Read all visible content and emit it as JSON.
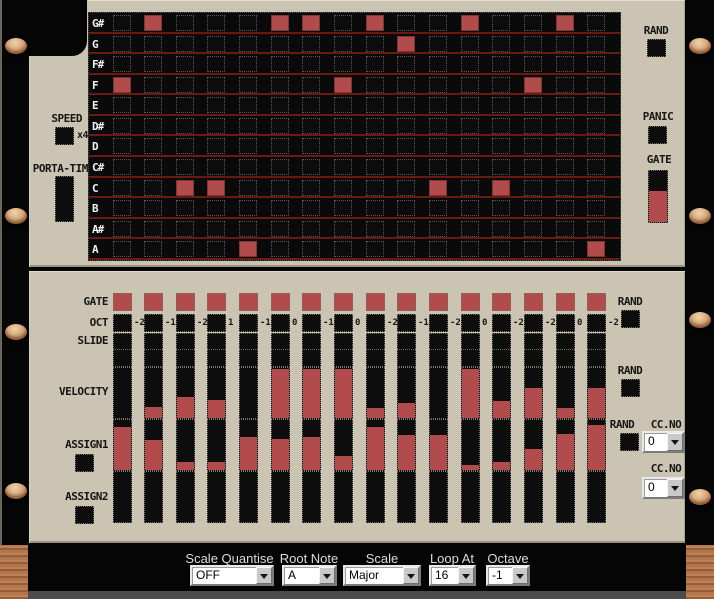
{
  "steps": 16,
  "colors": {
    "panel": "#cbc4b2",
    "active_step": "#b24c4c",
    "grid_line": "#6b1a12",
    "grid_bg": "#0a0a0a",
    "screw": "#d8a97c",
    "wood": "#b3754a"
  },
  "top_panel": {
    "speed": {
      "label": "SPEED",
      "value": "x4"
    },
    "porta": {
      "label": "PORTA-TIME"
    },
    "rand_label": "RAND",
    "panic_label": "PANIC",
    "gate": {
      "label": "GATE",
      "fill": 0.6
    },
    "note_grid": {
      "rows": [
        {
          "label": "G#",
          "steps": [
            2,
            6,
            7,
            9,
            12,
            15
          ]
        },
        {
          "label": "G",
          "steps": [
            10
          ]
        },
        {
          "label": "F#",
          "steps": []
        },
        {
          "label": "F",
          "steps": [
            1,
            8,
            14
          ]
        },
        {
          "label": "E",
          "steps": []
        },
        {
          "label": "D#",
          "steps": []
        },
        {
          "label": "D",
          "steps": []
        },
        {
          "label": "C#",
          "steps": []
        },
        {
          "label": "C",
          "steps": [
            3,
            4,
            11,
            13
          ]
        },
        {
          "label": "B",
          "steps": []
        },
        {
          "label": "A#",
          "steps": []
        },
        {
          "label": "A",
          "steps": [
            5,
            16
          ]
        }
      ]
    }
  },
  "bottom_panel": {
    "gate": {
      "label": "GATE",
      "values": [
        1,
        1,
        1,
        1,
        1,
        1,
        1,
        1,
        1,
        1,
        1,
        1,
        1,
        1,
        1,
        1
      ]
    },
    "oct": {
      "label": "OCT",
      "values": [
        -2,
        -1,
        -2,
        1,
        -1,
        0,
        -1,
        0,
        -2,
        -1,
        -2,
        0,
        -2,
        -2,
        0,
        -2
      ]
    },
    "slide": {
      "label": "SLIDE",
      "values": [
        0,
        0,
        0,
        0,
        0,
        0,
        0,
        0,
        0,
        0,
        0,
        0,
        0,
        0,
        0,
        0
      ]
    },
    "extra_row": {
      "values": [
        0,
        0,
        0,
        0,
        0,
        0,
        0,
        0,
        0,
        0,
        0,
        0,
        0,
        0,
        0,
        0
      ]
    },
    "velocity": {
      "label": "VELOCITY",
      "values": [
        0,
        0.22,
        0.42,
        0.36,
        0,
        0.97,
        0.97,
        0.97,
        0.2,
        0.3,
        0,
        0.97,
        0.33,
        0.6,
        0.2,
        0.6
      ]
    },
    "assign1": {
      "label": "ASSIGN1",
      "values": [
        0.85,
        0.6,
        0.15,
        0.15,
        0.66,
        0.62,
        0.65,
        0.28,
        0.85,
        0.69,
        0.7,
        0.1,
        0.15,
        0.42,
        0.72,
        0.9
      ]
    },
    "assign2": {
      "label": "ASSIGN2",
      "values": [
        0,
        0,
        0,
        0,
        0,
        0,
        0,
        0,
        0,
        0,
        0,
        0,
        0,
        0,
        0,
        0
      ]
    },
    "rand_label": "RAND",
    "ccno_label": "CC.NO",
    "cc1": {
      "value": "0"
    },
    "cc2": {
      "value": "0"
    }
  },
  "bottom_bar": {
    "dropdowns": [
      {
        "label": "Scale Quantise",
        "value": "OFF"
      },
      {
        "label": "Root Note",
        "value": "A"
      },
      {
        "label": "Scale",
        "value": "Major"
      },
      {
        "label": "Loop At",
        "value": "16"
      },
      {
        "label": "Octave",
        "value": "-1"
      }
    ]
  }
}
